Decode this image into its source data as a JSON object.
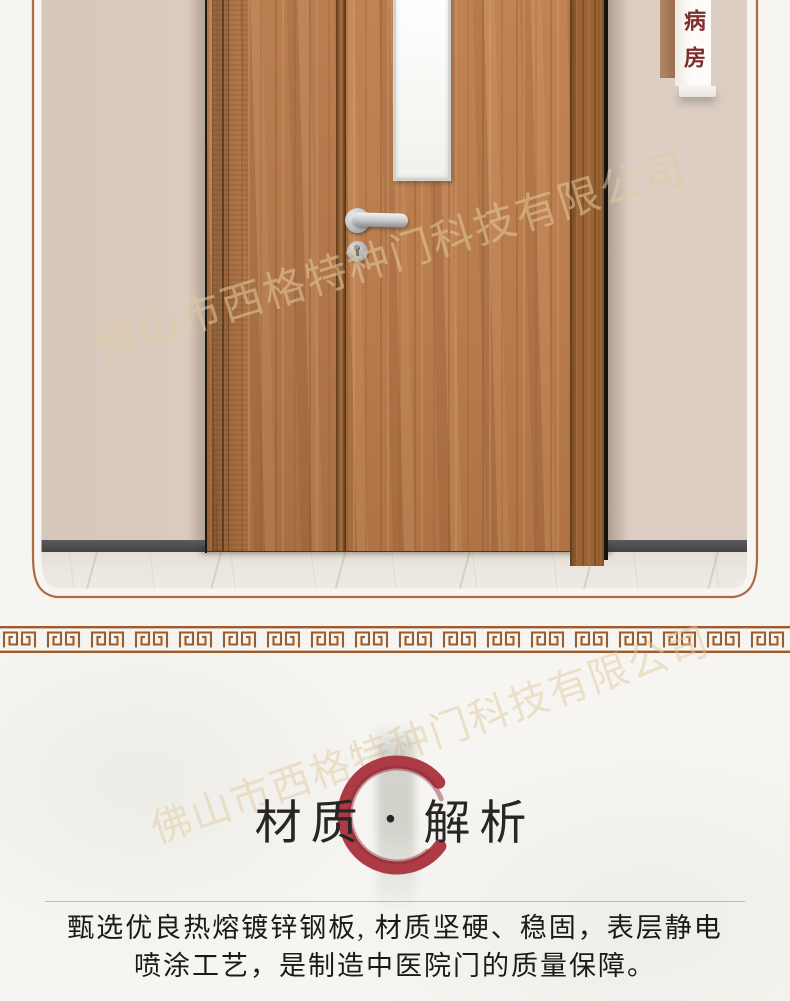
{
  "photo": {
    "sign": {
      "label": "病房"
    }
  },
  "section": {
    "title": {
      "left": "材质",
      "separator": "·",
      "right": "解析"
    },
    "description": {
      "line1": "甄选优良热熔镀锌钢板, 材质坚硬、稳固，表层静电",
      "line2": "喷涂工艺，是制造中医院门的质量保障。"
    }
  },
  "watermark": {
    "company": "佛山市西格特种门科技有限公司"
  },
  "colors": {
    "accent_red": "#ac3b46",
    "frame_brown": "#ad6b44",
    "meander_brown": "#9e5c2d",
    "sign_text_red": "#7c2e2b",
    "wall_beige": "#d8cabd",
    "door_wood": "#b1784a",
    "paper": "#f6f5f1"
  }
}
